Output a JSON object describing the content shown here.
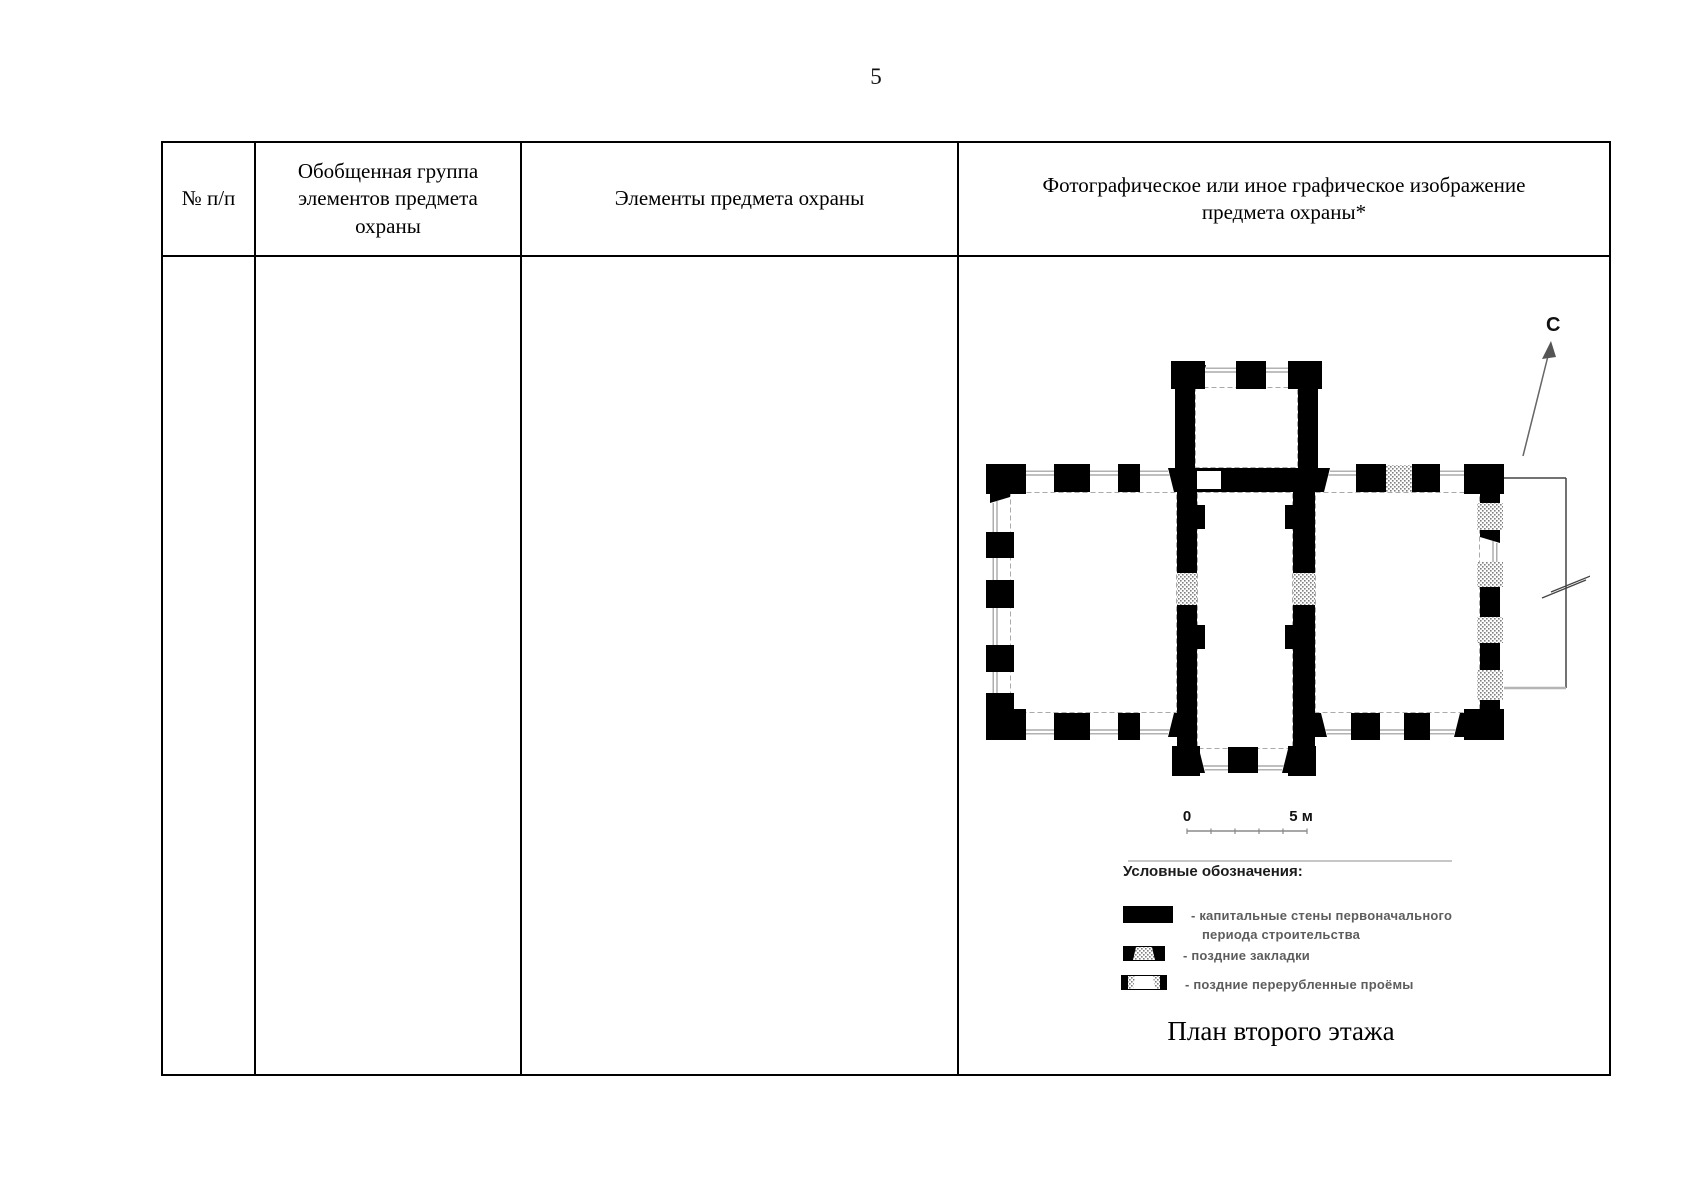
{
  "page": {
    "number": "5"
  },
  "table": {
    "headers": [
      "№ п/п",
      "Обобщенная группа элементов предмета охраны",
      "Элементы предмета охраны",
      "Фотографическое или иное графическое изображение предмета охраны*"
    ]
  },
  "figure": {
    "north_label": "С",
    "scale_bar": {
      "start_label": "0",
      "end_label": "5 м"
    },
    "legend": {
      "title": "Условные обозначения:",
      "items": [
        {
          "line1": "- капитальные стены первоначального",
          "line2": "периода строительства"
        },
        {
          "line1": "-  поздние закладки"
        },
        {
          "line1": "-  поздние перерубленные проёмы"
        }
      ]
    },
    "caption": "План второго этажа",
    "colors": {
      "wall": "#000000",
      "late_infill_gray": "#7f7f7f"
    }
  }
}
